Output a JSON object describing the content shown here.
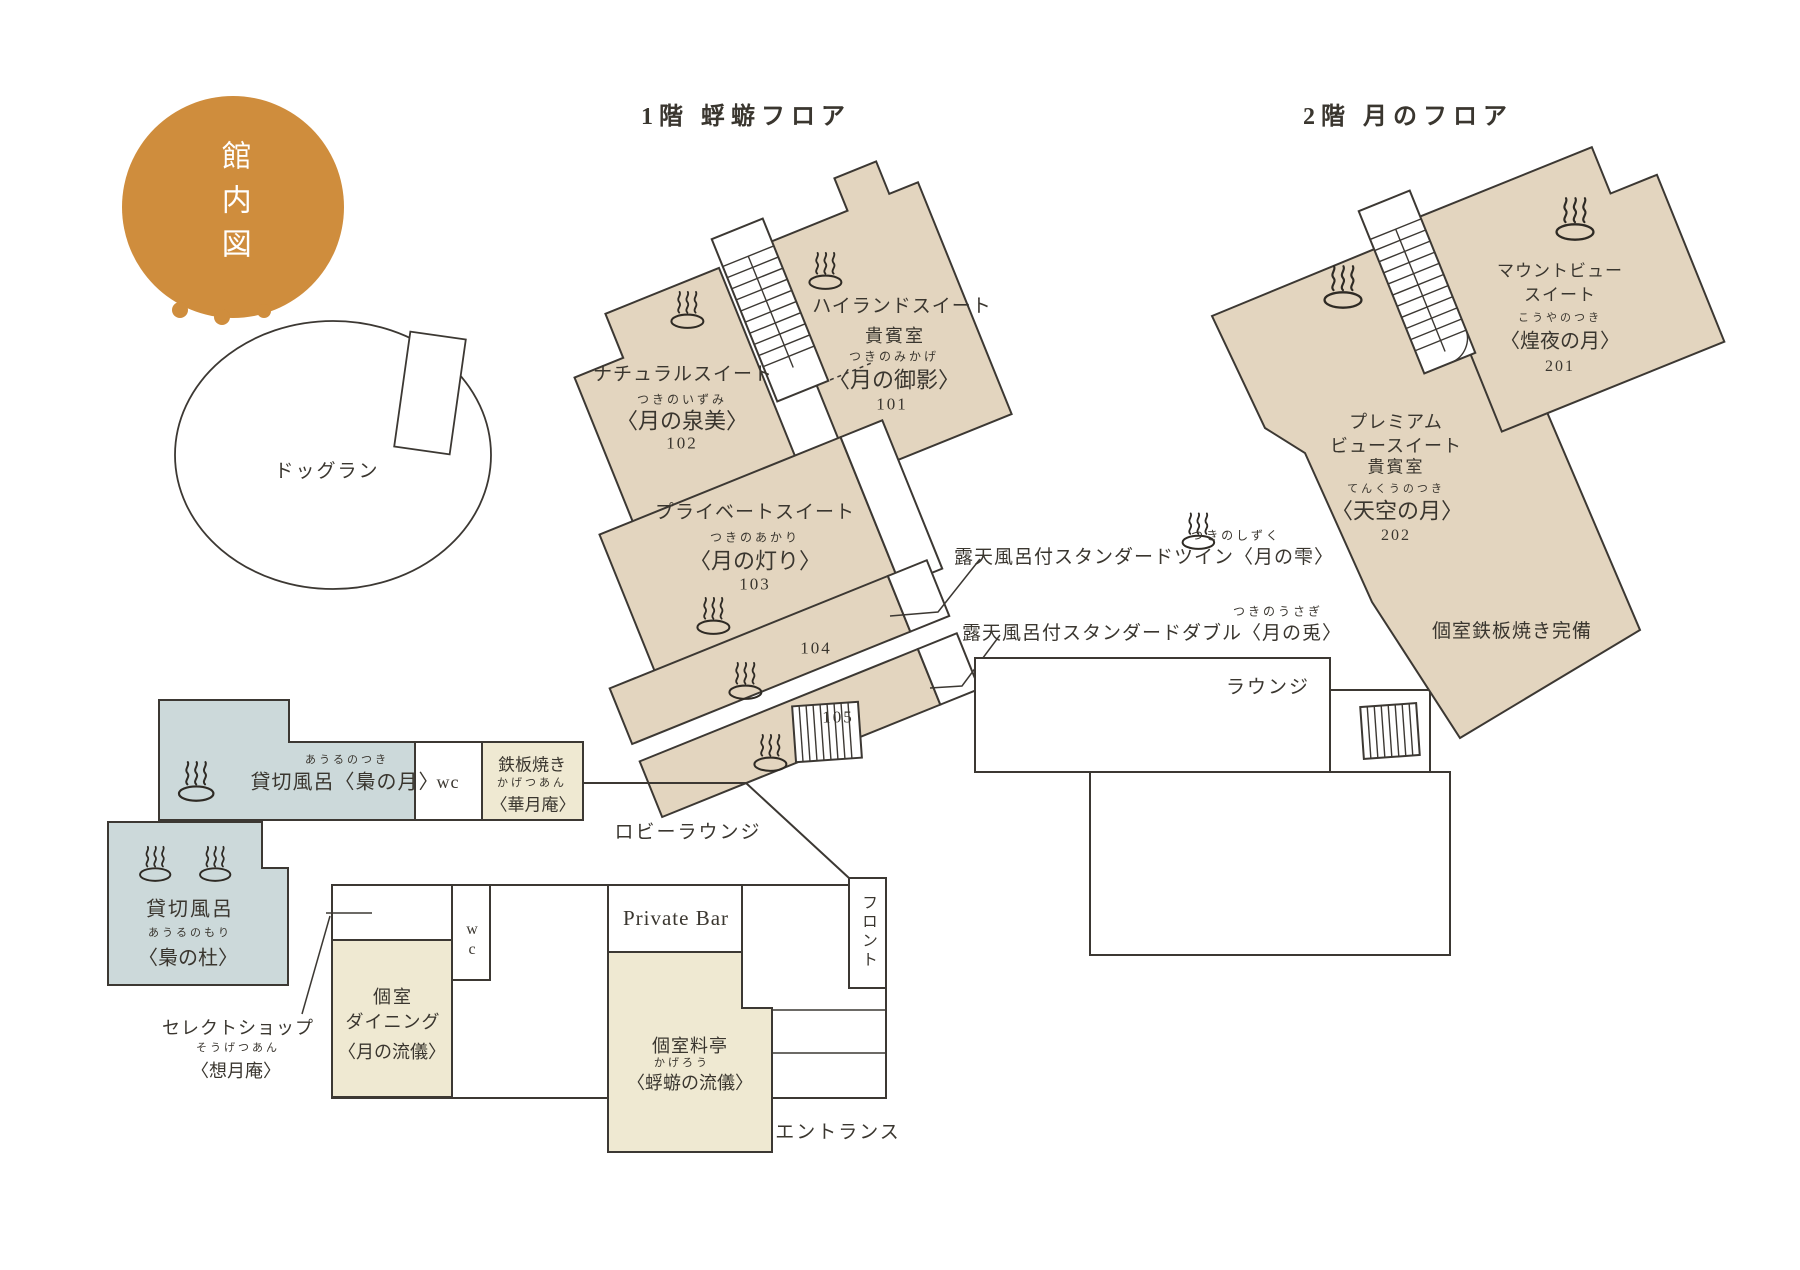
{
  "colors": {
    "accent_orange": "#cf8d3d",
    "room_beige": "#e3d5bf",
    "bath_blue": "#ccd9da",
    "dining_cream": "#efe9d2",
    "line_dark": "#3c3833"
  },
  "legend": {
    "map_title": "館内図"
  },
  "floor1": {
    "title": "1階 蜉蝣フロア",
    "dog_run": "ドッグラン",
    "rooms": {
      "natural": {
        "type": "ナチュラルスイート",
        "furigana": "つきのいずみ",
        "name": "〈月の泉美〉",
        "number": "102"
      },
      "highland": {
        "type": "ハイランドスイート",
        "grade": "貴賓室",
        "furigana": "つきのみかげ",
        "name": "〈月の御影〉",
        "number": "101"
      },
      "private": {
        "type": "プライベートスイート",
        "furigana": "つきのあかり",
        "name": "〈月の灯り〉",
        "number": "103"
      },
      "room104": "104",
      "room105": "105"
    },
    "annotations": {
      "twin": {
        "furigana": "つきのしずく",
        "text": "露天風呂付スタンダードツイン〈月の雫〉"
      },
      "double": {
        "furigana": "つきのうさぎ",
        "text": "露天風呂付スタンダードダブル〈月の兎〉"
      }
    },
    "facilities": {
      "bath_owl_moon": {
        "furigana": "あうるのつき",
        "text": "貸切風呂〈梟の月〉"
      },
      "wc_upper": "wc",
      "teppanyaki": {
        "line1": "鉄板焼き",
        "furigana": "かげつあん",
        "line2": "〈華月庵〉"
      },
      "lobby_lounge": "ロビーラウンジ",
      "bath_owl_forest": {
        "line1": "貸切風呂",
        "furigana": "あうるのもり",
        "line2": "〈梟の杜〉"
      },
      "select_shop": {
        "line1": "セレクトショップ",
        "furigana": "そうげつあん",
        "line2": "〈想月庵〉"
      },
      "dining": {
        "line1": "個室",
        "line2": "ダイニング",
        "line3": "〈月の流儀〉"
      },
      "wc_lower": {
        "line1": "w",
        "line2": "c"
      },
      "private_bar": "Private Bar",
      "ryotei": {
        "line1": "個室料亭",
        "furigana": "かげろう",
        "line2": "〈蜉蝣の流儀〉"
      },
      "front_desk": "フロント",
      "entrance": "エントランス"
    }
  },
  "floor2": {
    "title": "2階 月のフロア",
    "rooms": {
      "mountview": {
        "type1": "マウントビュー",
        "type2": "スイート",
        "furigana": "こうやのつき",
        "name": "〈煌夜の月〉",
        "number": "201"
      },
      "premium": {
        "type1": "プレミアム",
        "type2": "ビュースイート",
        "grade": "貴賓室",
        "furigana": "てんくうのつき",
        "name": "〈天空の月〉",
        "number": "202"
      }
    },
    "notes": {
      "teppan": "個室鉄板焼き完備",
      "lounge": "ラウンジ"
    }
  }
}
